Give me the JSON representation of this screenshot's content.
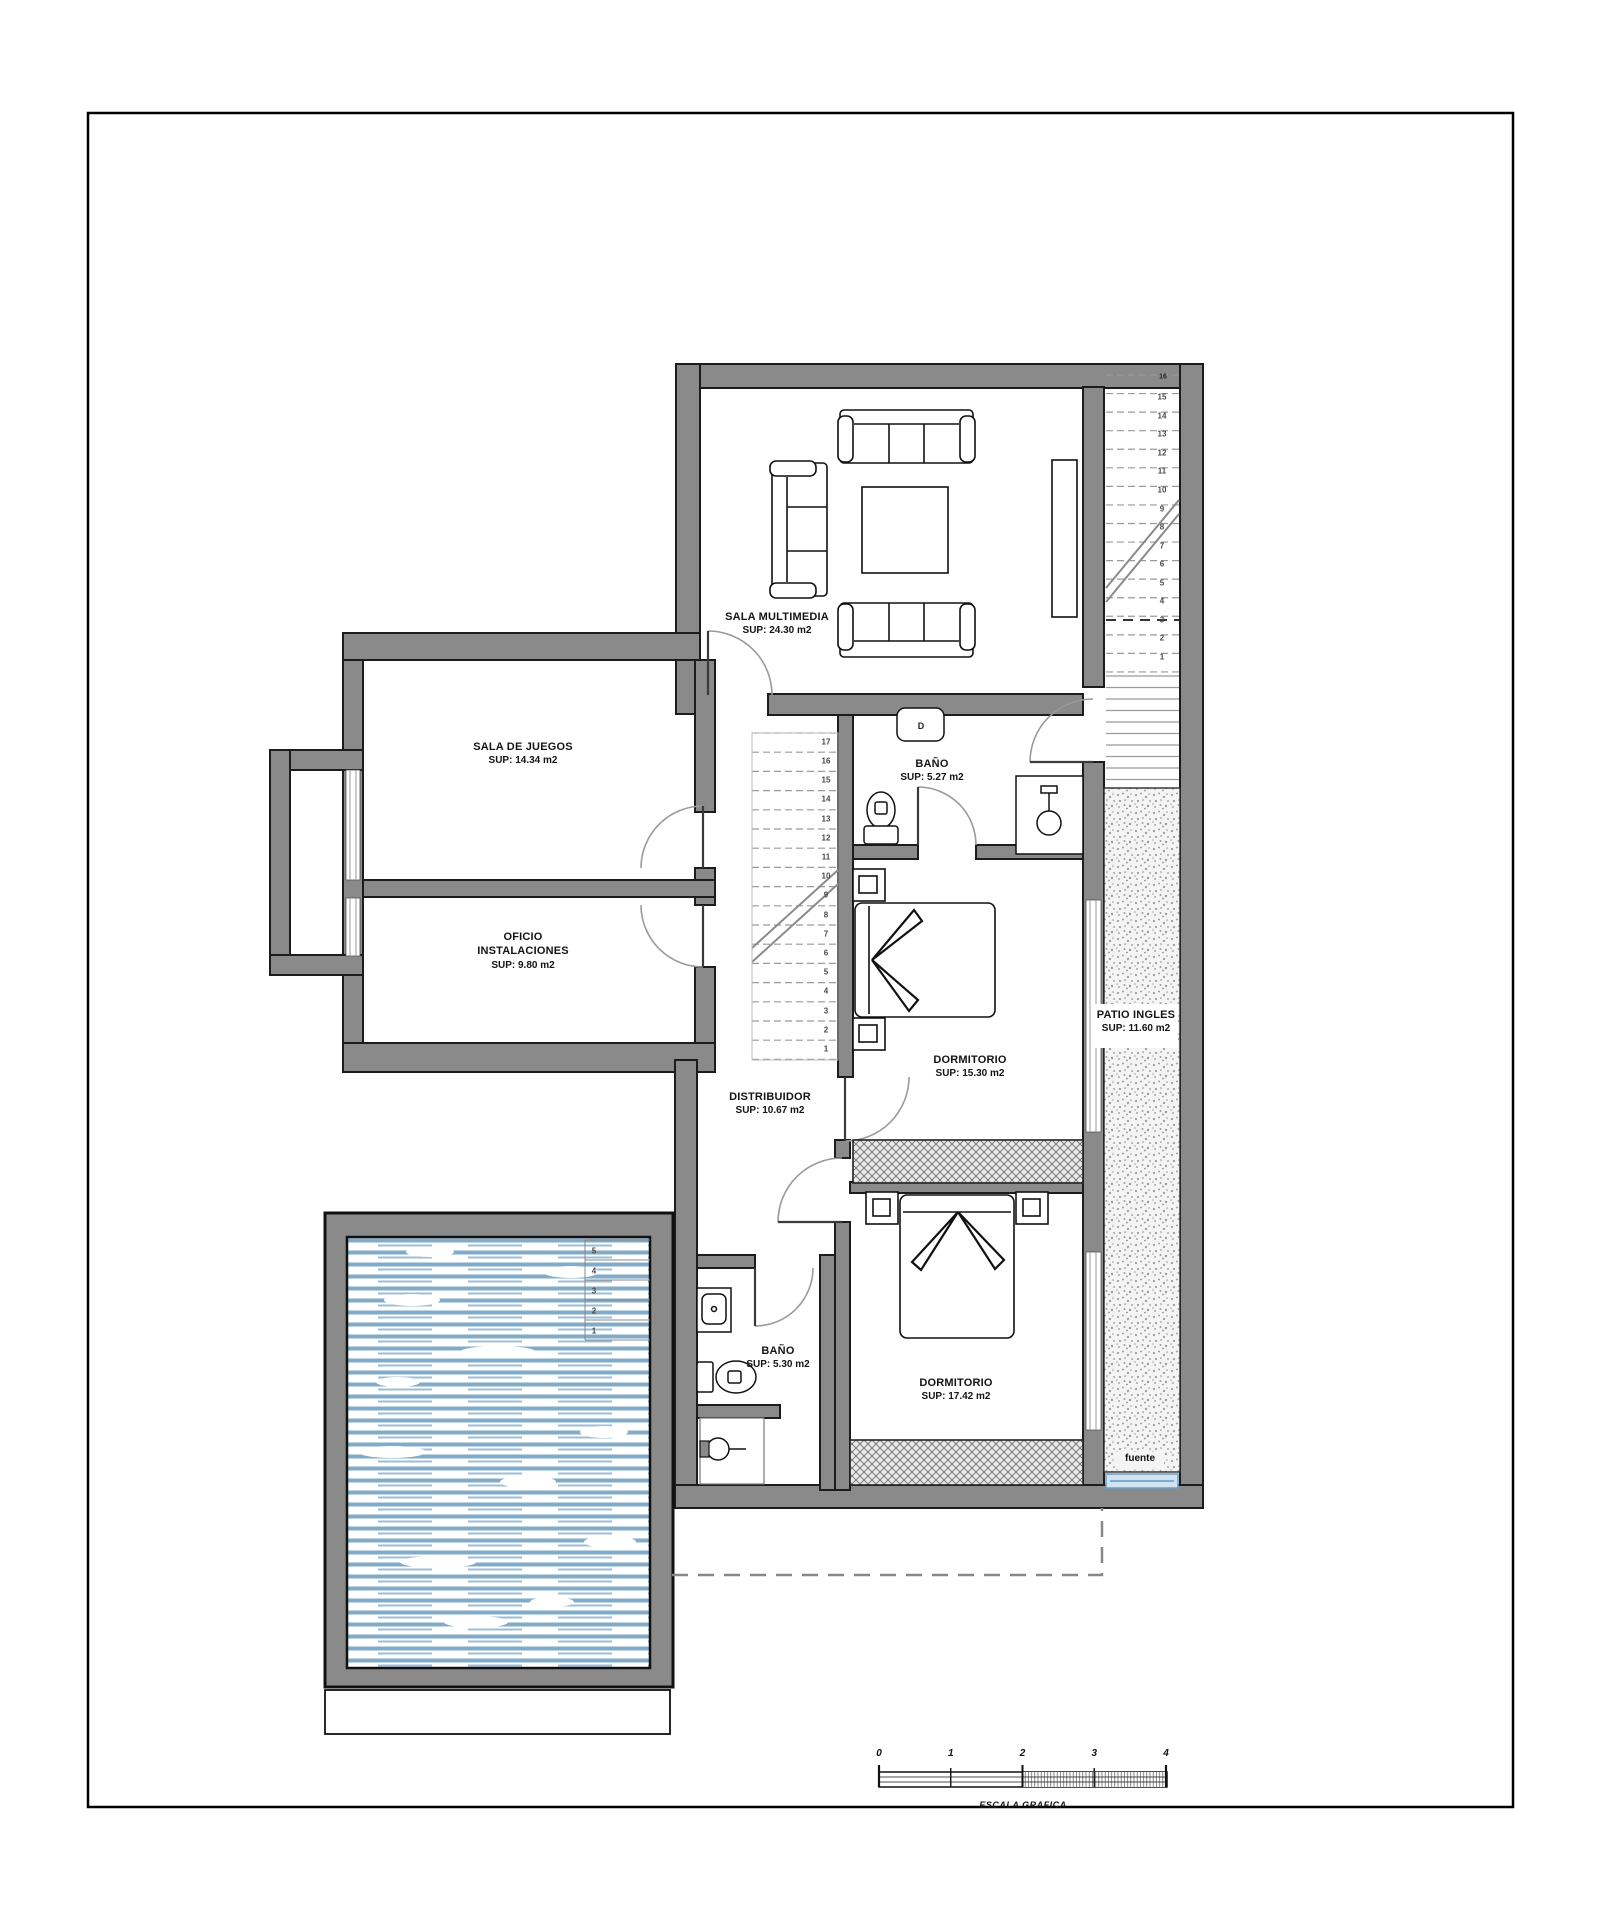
{
  "plan": {
    "rooms": [
      {
        "id": "sala-multimedia",
        "name": "SALA MULTIMEDIA",
        "area": "SUP: 24.30 m2"
      },
      {
        "id": "sala-de-juegos",
        "name": "SALA DE JUEGOS",
        "area": "SUP: 14.34 m2"
      },
      {
        "id": "oficio-instalaciones",
        "name": "OFICIO",
        "name2": "INSTALACIONES",
        "area": "SUP: 9.80 m2"
      },
      {
        "id": "bano-superior",
        "name": "BAÑO",
        "area": "SUP: 5.27 m2"
      },
      {
        "id": "dormitorio-1",
        "name": "DORMITORIO",
        "area": "SUP: 15.30 m2"
      },
      {
        "id": "distribuidor",
        "name": "DISTRIBUIDOR",
        "area": "SUP: 10.67 m2"
      },
      {
        "id": "bano-inferior",
        "name": "BAÑO",
        "area": "SUP: 5.30 m2"
      },
      {
        "id": "dormitorio-2",
        "name": "DORMITORIO",
        "area": "SUP: 17.42 m2"
      },
      {
        "id": "patio-ingles",
        "name": "PATIO INGLES",
        "area": "SUP: 11.60 m2"
      }
    ],
    "annotations": {
      "fuente": "fuente",
      "stair_top_number": "16",
      "appliance_label": "D"
    },
    "stairs": {
      "main_numbers": [
        1,
        2,
        3,
        4,
        5,
        6,
        7,
        8,
        9,
        10,
        11,
        12,
        13,
        14,
        15,
        16,
        17
      ],
      "side_numbers": [
        1,
        2,
        3,
        4,
        5,
        6,
        7,
        8,
        9,
        10,
        11,
        12,
        13,
        14,
        15
      ],
      "pool_step_numbers": [
        5,
        4,
        3,
        2,
        1
      ]
    },
    "scale_bar": {
      "ticks": [
        "0",
        "1",
        "2",
        "3",
        "4"
      ],
      "label": "ESCALA GRAFICA"
    },
    "colors": {
      "wall": "#8a8a8a",
      "outline": "#1c1c1c",
      "water": "#82abc9",
      "water_edge": "#6f9cc0",
      "gravel_dot": "#9b9b9b"
    }
  }
}
